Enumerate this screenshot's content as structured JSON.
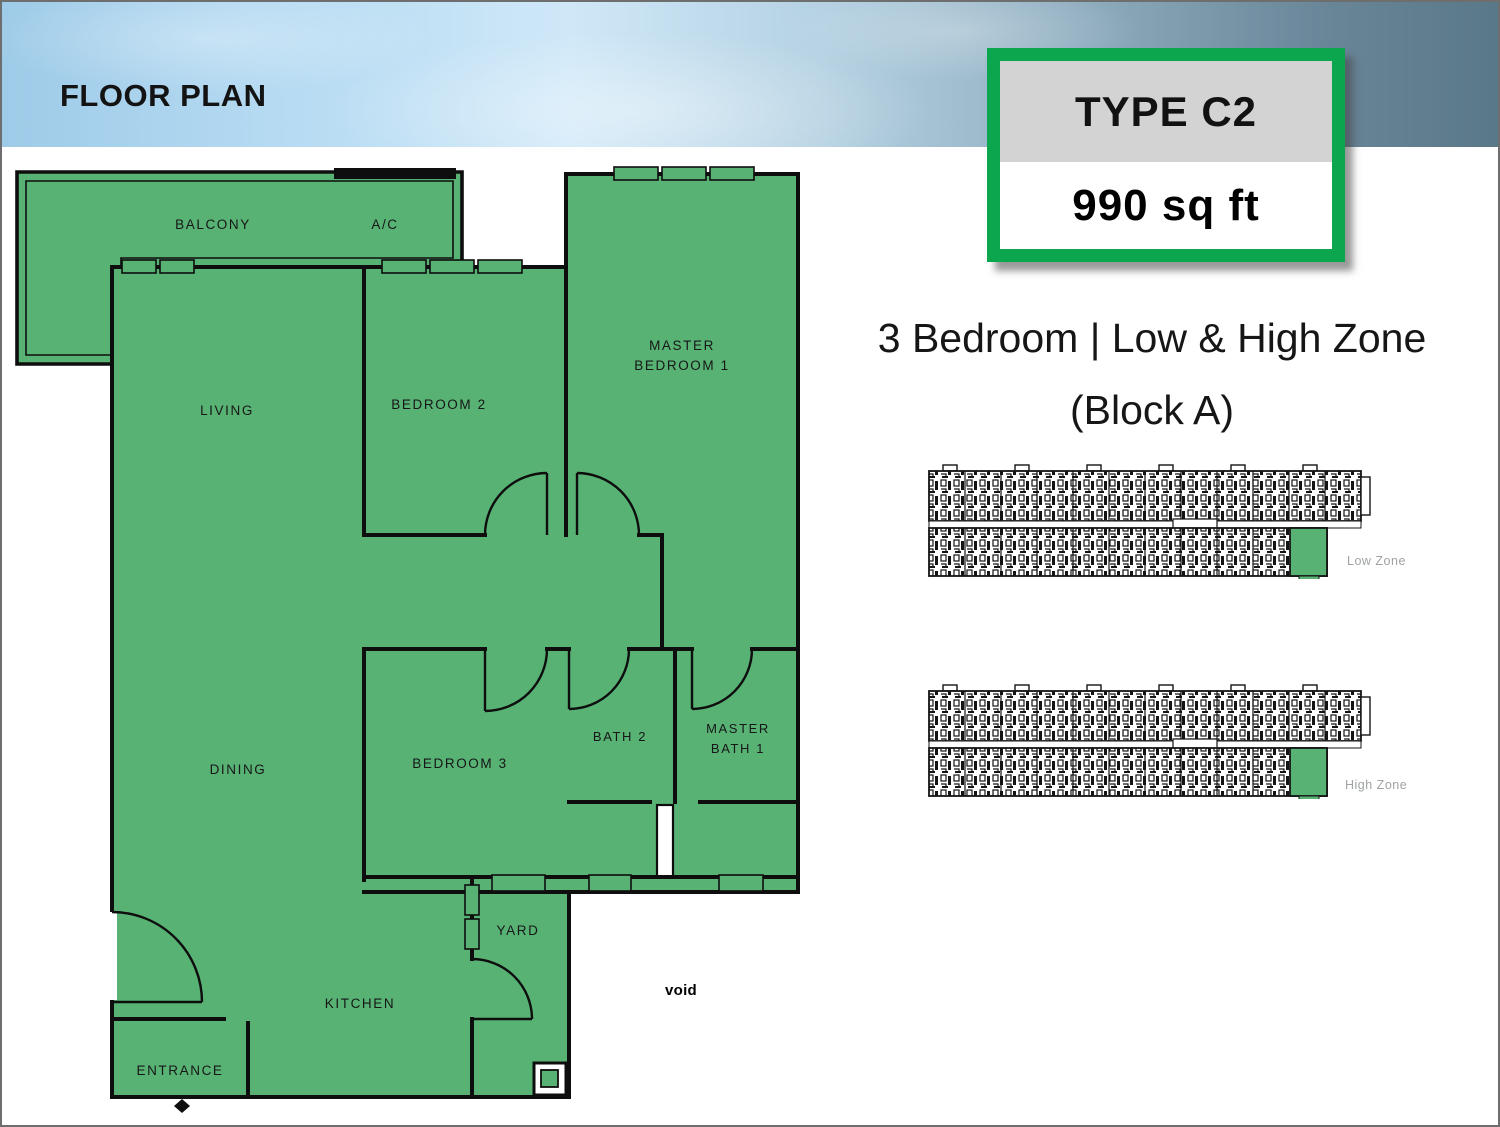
{
  "header": {
    "title": "FLOOR PLAN"
  },
  "badge": {
    "type": "TYPE C2",
    "area": "990 sq ft"
  },
  "headline": {
    "line1": "3 Bedroom | Low & High Zone",
    "line2": "(Block A)"
  },
  "plan": {
    "balcony": "BALCONY",
    "ac": "A/C",
    "living": "LIVING",
    "bedroom2": "BEDROOM 2",
    "master_bedroom": {
      "line1": "MASTER",
      "line2": "BEDROOM 1"
    },
    "dining": "DINING",
    "bedroom3": "BEDROOM 3",
    "bath2": "BATH 2",
    "master_bath": {
      "line1": "MASTER",
      "line2": "BATH 1"
    },
    "yard": "YARD",
    "kitchen": "KITCHEN",
    "entrance": "ENTRANCE",
    "void": "void"
  },
  "key_plans": [
    {
      "label": "Low Zone"
    },
    {
      "label": "High Zone"
    }
  ],
  "colors": {
    "accent_green": "#0ba64e",
    "room_fill": "#57b274",
    "badge_gray": "#d3d3d3",
    "header_left": "#9ecbe8",
    "header_right": "#597888",
    "zone_label_gray": "#9fa3a3"
  }
}
